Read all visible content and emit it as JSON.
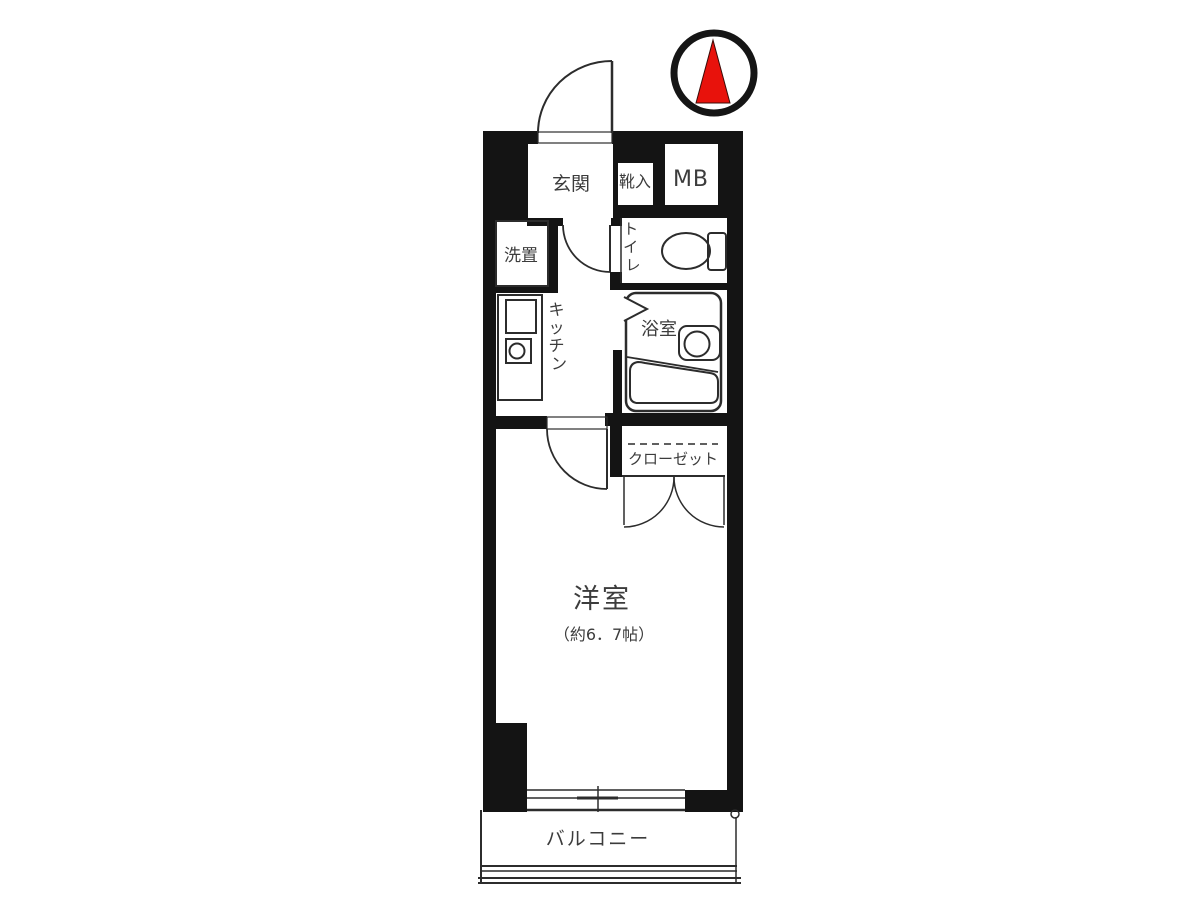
{
  "plan": {
    "type": "japanese-apartment-floor-plan",
    "compass": {
      "points": "north",
      "needle_color": "#e8120c",
      "ring_color": "#151515"
    },
    "labels": {
      "genkan": "玄関",
      "shoe_cabinet": "靴入",
      "meter_box": "MB",
      "toilet": "トイレ",
      "toilet_chars": [
        "ト",
        "イ",
        "レ"
      ],
      "laundry": "洗置",
      "kitchen": "キッチン",
      "kitchen_chars": [
        "キ",
        "ッ",
        "チ",
        "ン"
      ],
      "bathroom": "浴室",
      "closet": "クローゼット",
      "main_room": "洋室",
      "main_room_size": "（約6．7帖）",
      "balcony": "バルコニー"
    },
    "colors": {
      "wall": "#141414",
      "line": "#2c2c2c",
      "text": "#3c3c3c",
      "background": "#ffffff"
    }
  }
}
